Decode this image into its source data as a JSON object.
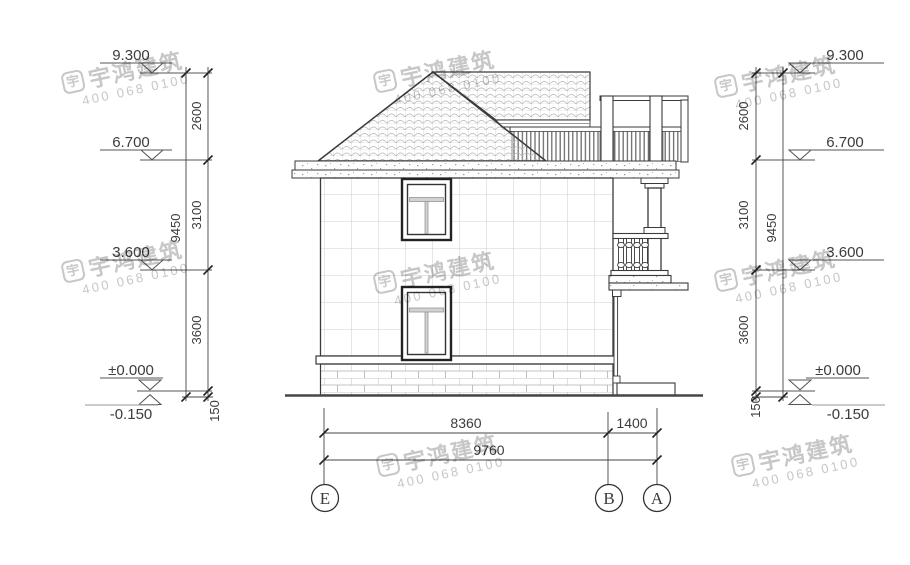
{
  "watermark": {
    "logo_char": "宇",
    "company": "宇鸿建筑",
    "phone": "400 068 0100"
  },
  "elevation_levels": {
    "roof_peak": "9.300",
    "eave": "6.700",
    "second_floor": "3.600",
    "ground_floor": "±0.000",
    "site": "-0.150"
  },
  "vertical_dimensions": {
    "roof": "2600",
    "second_storey": "3100",
    "first_storey": "3600",
    "plinth": "150",
    "total": "9450"
  },
  "horizontal_dimensions": {
    "span_e_b": "8360",
    "span_b_a": "1400",
    "total": "9760"
  },
  "grid_axes": {
    "left": "E",
    "middle": "B",
    "right": "A"
  }
}
